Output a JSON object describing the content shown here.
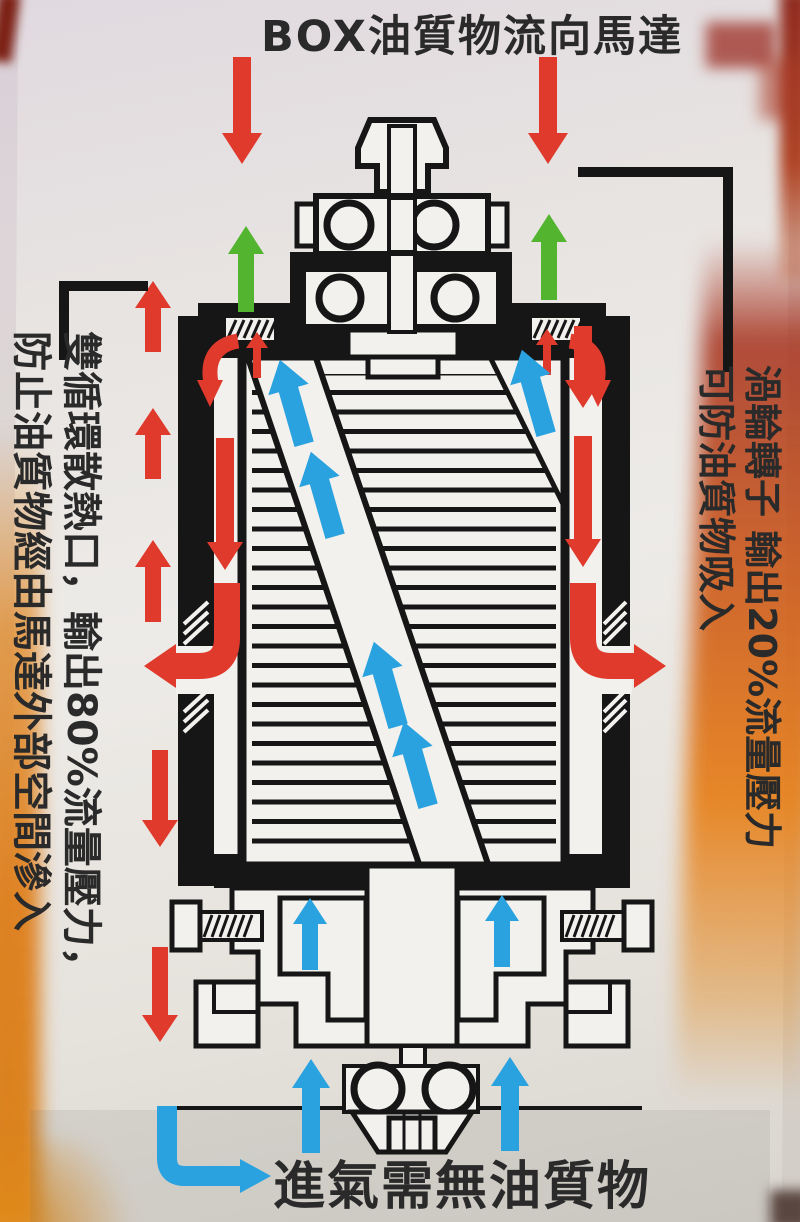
{
  "labels": {
    "top_title": "BOX油質物流向馬達",
    "bottom_label": "進氣需無油質物",
    "right_line1": "渦輪轉子 輸出20%流量壓力",
    "right_line2": "可防油質物吸入",
    "left_line1": "雙循環散熱口，輸出80%流量壓力，",
    "left_line2": "防止油質物經由馬達外部空間滲入"
  },
  "colors": {
    "red_arrow": "#e03a2c",
    "green_arrow": "#53b430",
    "blue_arrow": "#2aa2df",
    "drawing_ink": "#161616",
    "text_ink": "#2a2a2a"
  },
  "diagram": {
    "type": "motor-cross-section-flow-diagram",
    "flows": {
      "red": "oil-laden BOX flow entering top, 80% exits left heat-dissipation port",
      "green": "upward vent flow at motor top",
      "blue": "clean intake air rising through rotor channel and base"
    }
  }
}
